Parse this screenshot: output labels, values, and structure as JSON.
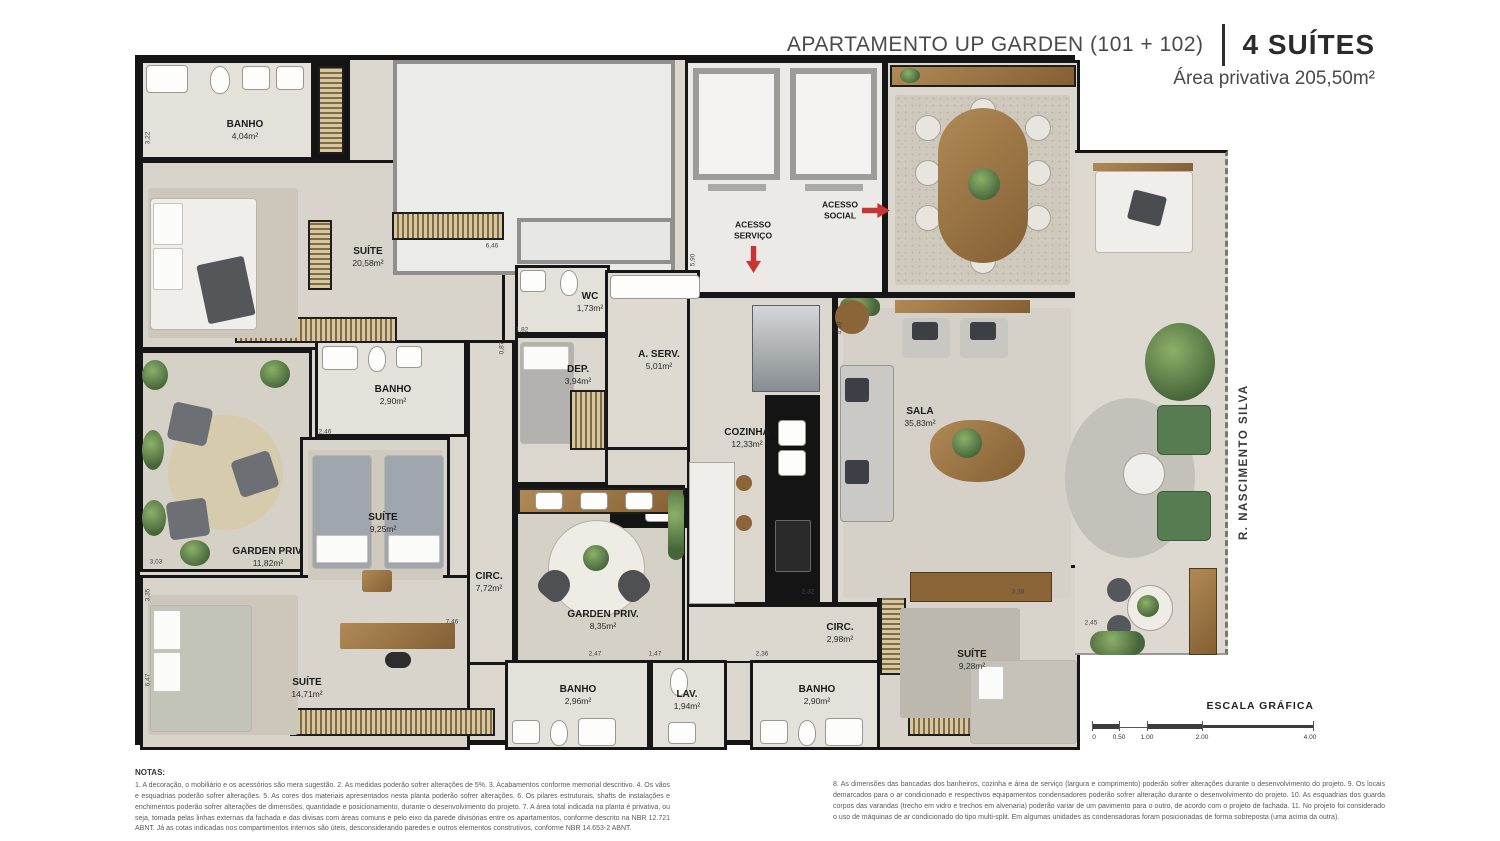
{
  "header": {
    "title": "APARTAMENTO UP GARDEN (101 + 102)",
    "suites": "4 SUÍTES",
    "area": "Área privativa 205,50m²"
  },
  "plan": {
    "street": "R. NASCIMENTO SILVA",
    "access_servico": "ACESSO\nSERVIÇO",
    "access_social": "ACESSO\nSOCIAL",
    "rooms": [
      {
        "id": "banho-1",
        "label": "BANHO",
        "area": "4,04m²"
      },
      {
        "id": "suite-1",
        "label": "SUÍTE",
        "area": "20,58m²"
      },
      {
        "id": "wc",
        "label": "WC",
        "area": "1,73m²"
      },
      {
        "id": "dep",
        "label": "DEP.",
        "area": "3,94m²"
      },
      {
        "id": "a-serv",
        "label": "A. SERV.",
        "area": "5,01m²"
      },
      {
        "id": "cozinha",
        "label": "COZINHA",
        "area": "12,33m²"
      },
      {
        "id": "sala",
        "label": "SALA",
        "area": "35,83m²"
      },
      {
        "id": "varanda",
        "label": "VARANDA",
        "area": "21,78m²"
      },
      {
        "id": "banho-2",
        "label": "BANHO",
        "area": "2,90m²"
      },
      {
        "id": "garden-priv-1",
        "label": "GARDEN PRIV.",
        "area": "11,82m²"
      },
      {
        "id": "suite-2",
        "label": "SUÍTE",
        "area": "9,25m²"
      },
      {
        "id": "circ-1",
        "label": "CIRC.",
        "area": "7,72m²"
      },
      {
        "id": "garden-priv-2",
        "label": "GARDEN PRIV.",
        "area": "8,35m²"
      },
      {
        "id": "suite-3",
        "label": "SUÍTE",
        "area": "14,71m²"
      },
      {
        "id": "circ-2",
        "label": "CIRC.",
        "area": "2,98m²"
      },
      {
        "id": "banho-3",
        "label": "BANHO",
        "area": "2,96m²"
      },
      {
        "id": "lav",
        "label": "LAV.",
        "area": "1,94m²"
      },
      {
        "id": "banho-4",
        "label": "BANHO",
        "area": "2,90m²"
      },
      {
        "id": "suite-4",
        "label": "SUÍTE",
        "area": "9,28m²"
      }
    ],
    "dimensions": [
      "3,22",
      "6,46",
      "0,87",
      "5,90",
      "2,46",
      "3,03",
      "7,46",
      "2,47",
      "1,47",
      "2,36",
      "3,38",
      "2,45",
      "4,40",
      "2,32",
      "6,47",
      "3,35",
      "1,82"
    ]
  },
  "scale": {
    "title": "ESCALA GRÁFICA",
    "ticks": [
      "0",
      "0.50",
      "1.00",
      "2.00",
      "4.00"
    ]
  },
  "notes": {
    "heading": "NOTAS:",
    "col_left": "1. A decoração, o mobiliário e os acessórios são mera sugestão. 2. As medidas poderão sofrer alterações de 5%. 3. Acabamentos conforme memorial descritivo. 4. Os vãos e esquadrias poderão sofrer alterações. 5. As cores dos materiais apresentados nesta planta poderão sofrer alterações. 6. Os pilares estruturais, shafts de instalações e enchimentos poderão sofrer alterações de dimensões, quantidade e posicionamento, durante o desenvolvimento do projeto. 7. A área total indicada na planta é privativa, ou seja, tomada pelas linhas externas da fachada e das divisas com áreas comuns e pelo eixo da parede divisórias entre os apartamentos, conforme descrito na NBR 12.721 ABNT. Já as cotas indicadas nos compartimentos internos são úteis, desconsiderando paredes e outros elementos construtivos, conforme NBR 14.653-2 ABNT.",
    "col_right": "8. As dimensões das bancadas dos banheiros, cozinha e área de serviço (largura e comprimento) poderão sofrer alterações durante o desenvolvimento do projeto. 9. Os locais demarcados para o ar condicionado e respectivos equipamentos condensadores poderão sofrer alteração durante o desenvolvimento do projeto. 10. As esquadrias dos guarda corpos das varandas (trecho em vidro e trechos em alvenaria) poderão variar de um pavimento para o outro, de acordo com o projeto de fachada. 11. No projeto foi considerado o uso de máquinas de ar condicionado do tipo multi-split. Em algumas unidades as condensadoras foram posicionadas de forma sobreposta (uma acima da outra)."
  }
}
